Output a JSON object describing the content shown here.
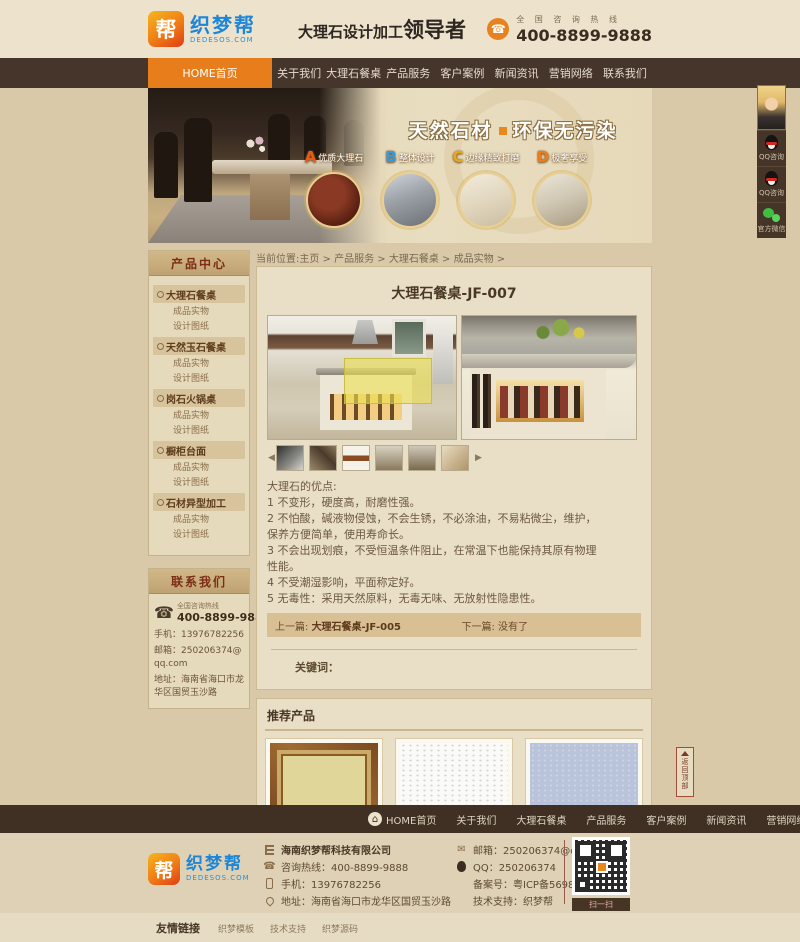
{
  "colors": {
    "accent_orange": "#e87d1c",
    "nav_brown": "#46352a",
    "page_beige": "#d9c9a9",
    "logo_blue": "#1d86d8"
  },
  "header": {
    "logo_badge": "帮",
    "logo_name": "织梦帮",
    "logo_domain": "DEDESOS.COM",
    "slogan_prefix": "大理石设计加工",
    "slogan_emphasis": "领导者",
    "hotline_label": "全 国 咨 询 热 线",
    "hotline_number": "400-8899-9888"
  },
  "nav": {
    "items": [
      "HOME首页",
      "关于我们",
      "大理石餐桌",
      "产品服务",
      "客户案例",
      "新闻资讯",
      "营销网络",
      "联系我们"
    ]
  },
  "banner": {
    "title_left": "天然石材",
    "title_right": "环保无污染",
    "features": [
      {
        "letter": "A",
        "label": "优质大理石"
      },
      {
        "letter": "B",
        "label": "整体设计"
      },
      {
        "letter": "C",
        "label": "边缘精致打磨"
      },
      {
        "letter": "D",
        "label": "极奢享受"
      }
    ]
  },
  "floating": {
    "qq1_label": "QQ咨询",
    "qq2_label": "QQ咨询",
    "wechat_label": "官方微信"
  },
  "sidebar": {
    "product_center_title": "产品中心",
    "categories": [
      {
        "name": "大理石餐桌",
        "sub1": "成品实物",
        "sub2": "设计图纸"
      },
      {
        "name": "天然玉石餐桌",
        "sub1": "成品实物",
        "sub2": "设计图纸"
      },
      {
        "name": "岗石火锅桌",
        "sub1": "成品实物",
        "sub2": "设计图纸"
      },
      {
        "name": "橱柜台面",
        "sub1": "成品实物",
        "sub2": "设计图纸"
      },
      {
        "name": "石材异型加工",
        "sub1": "成品实物",
        "sub2": "设计图纸"
      }
    ],
    "contact_title": "联系我们",
    "contact_hotline_label": "全国咨询热线",
    "contact_hotline": "400-8899-9888",
    "contact_mobile": "手机：13976782256",
    "contact_email": "邮箱：250206374@qq.com",
    "contact_address": "地址：海南省海口市龙华区国贸玉沙路"
  },
  "main": {
    "breadcrumb": "当前位置:主页 > 产品服务 > 大理石餐桌 > 成品实物 >",
    "title": "大理石餐桌-JF-007",
    "description": [
      "大理石的优点:",
      "1 不变形，硬度高，耐磨性强。",
      "2 不怕酸，碱液物侵蚀，不会生锈，不必涂油，不易粘微尘，维护，",
      "保养方便简单，使用寿命长。",
      "3 不会出现划痕，不受恒温条件阻止，在常温下也能保持其原有物理",
      "性能。",
      "4 不受潮湿影响，平面称定好。",
      "5 无毒性：采用天然原料，无毒无味、无放射性隐患性。"
    ],
    "prev_label": "上一篇:",
    "prev_title": "大理石餐桌-JF-005",
    "next_label": "下一篇:",
    "next_title": "没有了",
    "keywords_label": "关键词：",
    "recommend_title": "推荐产品",
    "recommend": [
      {
        "name": "大理石-A-206"
      },
      {
        "name": "大理石-玛赛"
      },
      {
        "name": "大理石-玛瑙"
      }
    ]
  },
  "back_to_top": "返回顶部",
  "footer_nav": {
    "items": [
      "HOME首页",
      "关于我们",
      "大理石餐桌",
      "产品服务",
      "客户案例",
      "新闻资讯",
      "营销网络",
      "联系我们"
    ]
  },
  "footer": {
    "company": "海南织梦帮科技有限公司",
    "hotline": "咨询热线：400-8899-9888",
    "mobile": "手机：13976782256",
    "address": "地址：海南省海口市龙华区国贸玉沙路",
    "email": "邮箱：250206374@qq.com",
    "qq": "QQ：250206374",
    "icp": "备案号：粤ICP备56984598号",
    "support": "技术支持：织梦帮",
    "qr_caption": "扫一扫"
  },
  "bottom": {
    "links_title": "友情链接",
    "links": [
      "织梦模板",
      "技术支持",
      "织梦源码"
    ]
  }
}
